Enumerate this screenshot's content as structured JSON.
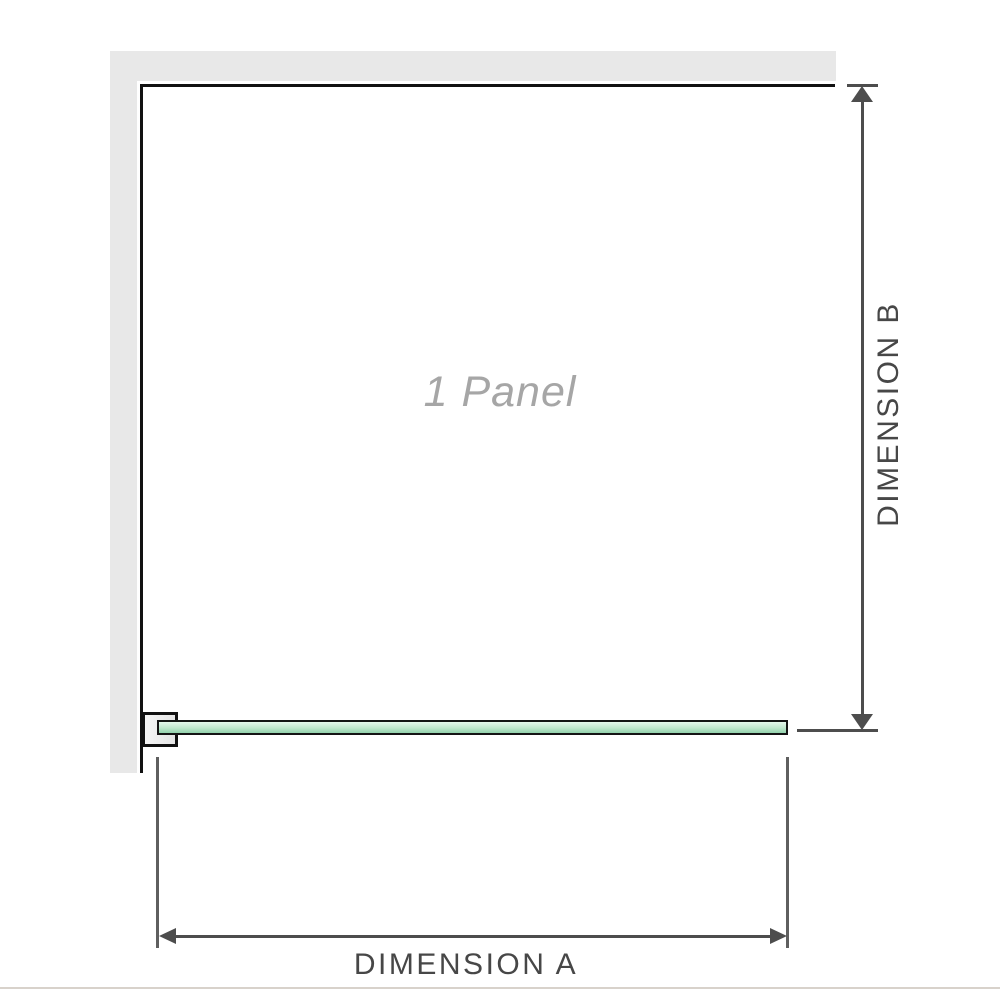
{
  "diagram": {
    "panel_label": "1 Panel",
    "dimension_a": {
      "label": "DIMENSION A"
    },
    "dimension_b": {
      "label": "DIMENSION B"
    },
    "colors": {
      "wall": "#e8e8e8",
      "outline": "#111111",
      "dimension": "#4d4d4d",
      "extension": "#5f5f5f",
      "glass_fill": "#bfe6cc",
      "glass_edge": "#93d2ac",
      "glass_highlight": "#e6f7ec",
      "glass_border": "#141414",
      "bracket_fill": "#e4e4e4",
      "label_text": "#474747",
      "panel_text": "#a6a6a6",
      "footer_rule": "#d8d2cb"
    }
  }
}
